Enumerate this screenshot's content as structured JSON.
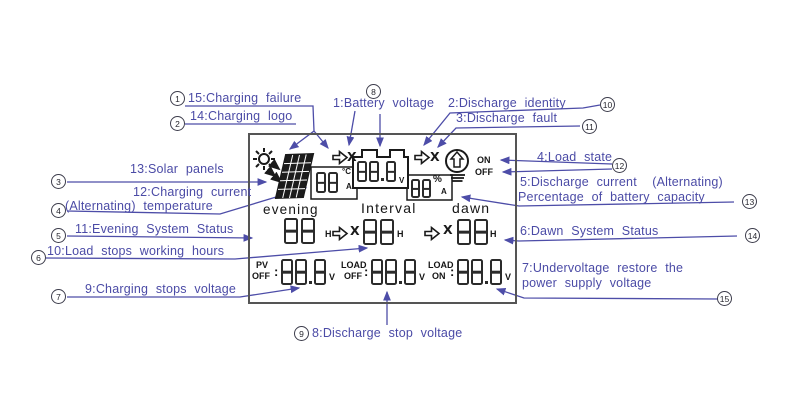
{
  "callouts": {
    "c1": {
      "badge": "1",
      "text": "15:Charging failure"
    },
    "c2": {
      "badge": "2",
      "text": "14:Charging logo"
    },
    "c3": {
      "badge": "3",
      "text": "13:Solar panels"
    },
    "c4": {
      "badge": "4",
      "text1": "12:Charging current",
      "text2": "(Alternating) temperature"
    },
    "c5": {
      "badge": "5",
      "text": "11:Evening System Status"
    },
    "c6": {
      "badge": "6",
      "text": "10:Load stops working hours"
    },
    "c7": {
      "badge": "7",
      "text": "9:Charging stops voltage"
    },
    "c8": {
      "badge": "8",
      "text": "1:Battery voltage"
    },
    "c9": {
      "badge": "9",
      "text": "8:Discharge stop voltage"
    },
    "c10": {
      "badge": "10",
      "text": "2:Discharge identity"
    },
    "c11": {
      "badge": "11",
      "text": "3:Discharge fault"
    },
    "c12": {
      "badge": "12",
      "text": "4:Load state"
    },
    "c13": {
      "badge": "13",
      "text1": "5:Discharge current  (Alternating)",
      "text2": "Percentage of battery capacity"
    },
    "c14": {
      "badge": "14",
      "text": "6:Dawn System Status"
    },
    "c15": {
      "badge": "15",
      "text1": "7:Undervoltage restore the",
      "text2": "power supply voltage"
    }
  },
  "lcd": {
    "separator": ":",
    "fault_mark": "X",
    "temp_group": {
      "digits": "88",
      "unit_top": "°C",
      "unit_bottom": "A"
    },
    "battery": {
      "digits": "88.8",
      "unit": "V"
    },
    "percent_group": {
      "digits": "88",
      "unit_top": "%",
      "unit_bottom": "A"
    },
    "load_state": {
      "on": "ON",
      "off": "OFF"
    },
    "periods": {
      "evening": "evening",
      "interval": "Interval",
      "dawn": "dawn"
    },
    "evening_hours": {
      "digits": "88",
      "unit": "H"
    },
    "interval_hours": {
      "digits": "88",
      "unit": "H"
    },
    "dawn_hours": {
      "digits": "88",
      "unit": "H"
    },
    "pv_off": {
      "label": "PV",
      "state": "OFF",
      "digits": "88.8",
      "unit": "V"
    },
    "load_off": {
      "label": "LOAD",
      "state": "OFF",
      "digits": "88.8",
      "unit": "V"
    },
    "load_on": {
      "label": "LOAD",
      "state": "ON",
      "digits": "88.8",
      "unit": "V"
    }
  },
  "colors": {
    "annotation": "#4b4ba6",
    "lcd_ink": "#1a1a1a",
    "frame": "#555555"
  }
}
